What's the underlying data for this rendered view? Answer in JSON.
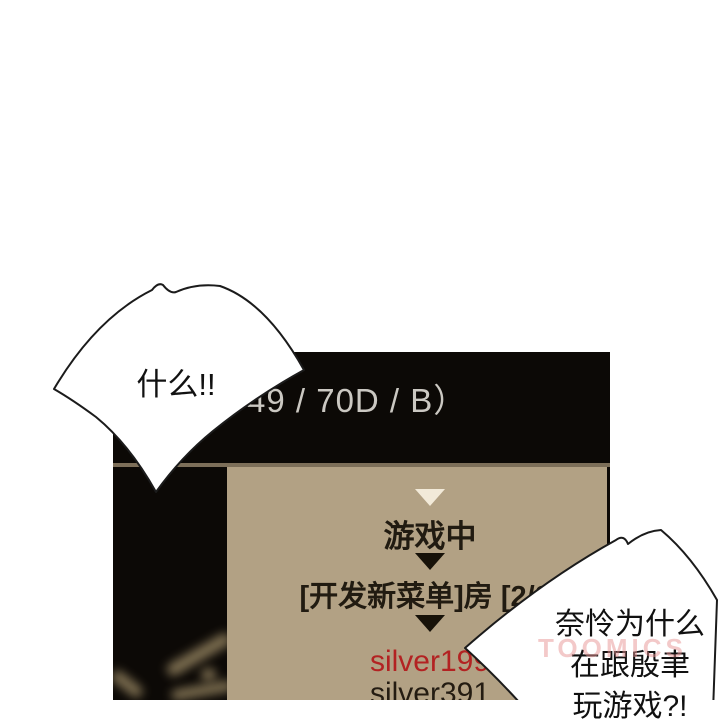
{
  "scene": {
    "type": "comic-panel-with-game-screenshot",
    "background_color": "#ffffff"
  },
  "colors": {
    "game_window_black": "#0c0906",
    "board_tan": "#b2a184",
    "separator": "#7d6f59",
    "header_text": "#cbc8c2",
    "cream_triangle": "#f2ead9",
    "dark_triangle": "#171209",
    "dark_text": "#211b11",
    "red_player": "#b32222",
    "bubble_outline": "#1b1b1b",
    "watermark_pink": "#e89494"
  },
  "game": {
    "header_text": "49 / 70D / B）",
    "status": "游戏中",
    "room_label": "[开发新菜单]房 [2/2]",
    "players": [
      {
        "name": "silver199",
        "color": "#b32222"
      },
      {
        "name": "silver391",
        "color": "#241c12"
      }
    ],
    "marker_icons": [
      "down-triangle-cream",
      "down-triangle-dark",
      "down-triangle-dark"
    ]
  },
  "speech_bubbles": [
    {
      "text": "什么!!"
    },
    {
      "lines": [
        "奈怜为什么",
        "在跟殷聿",
        "玩游戏?!"
      ]
    }
  ],
  "watermark": {
    "text": "TOOMICS"
  }
}
